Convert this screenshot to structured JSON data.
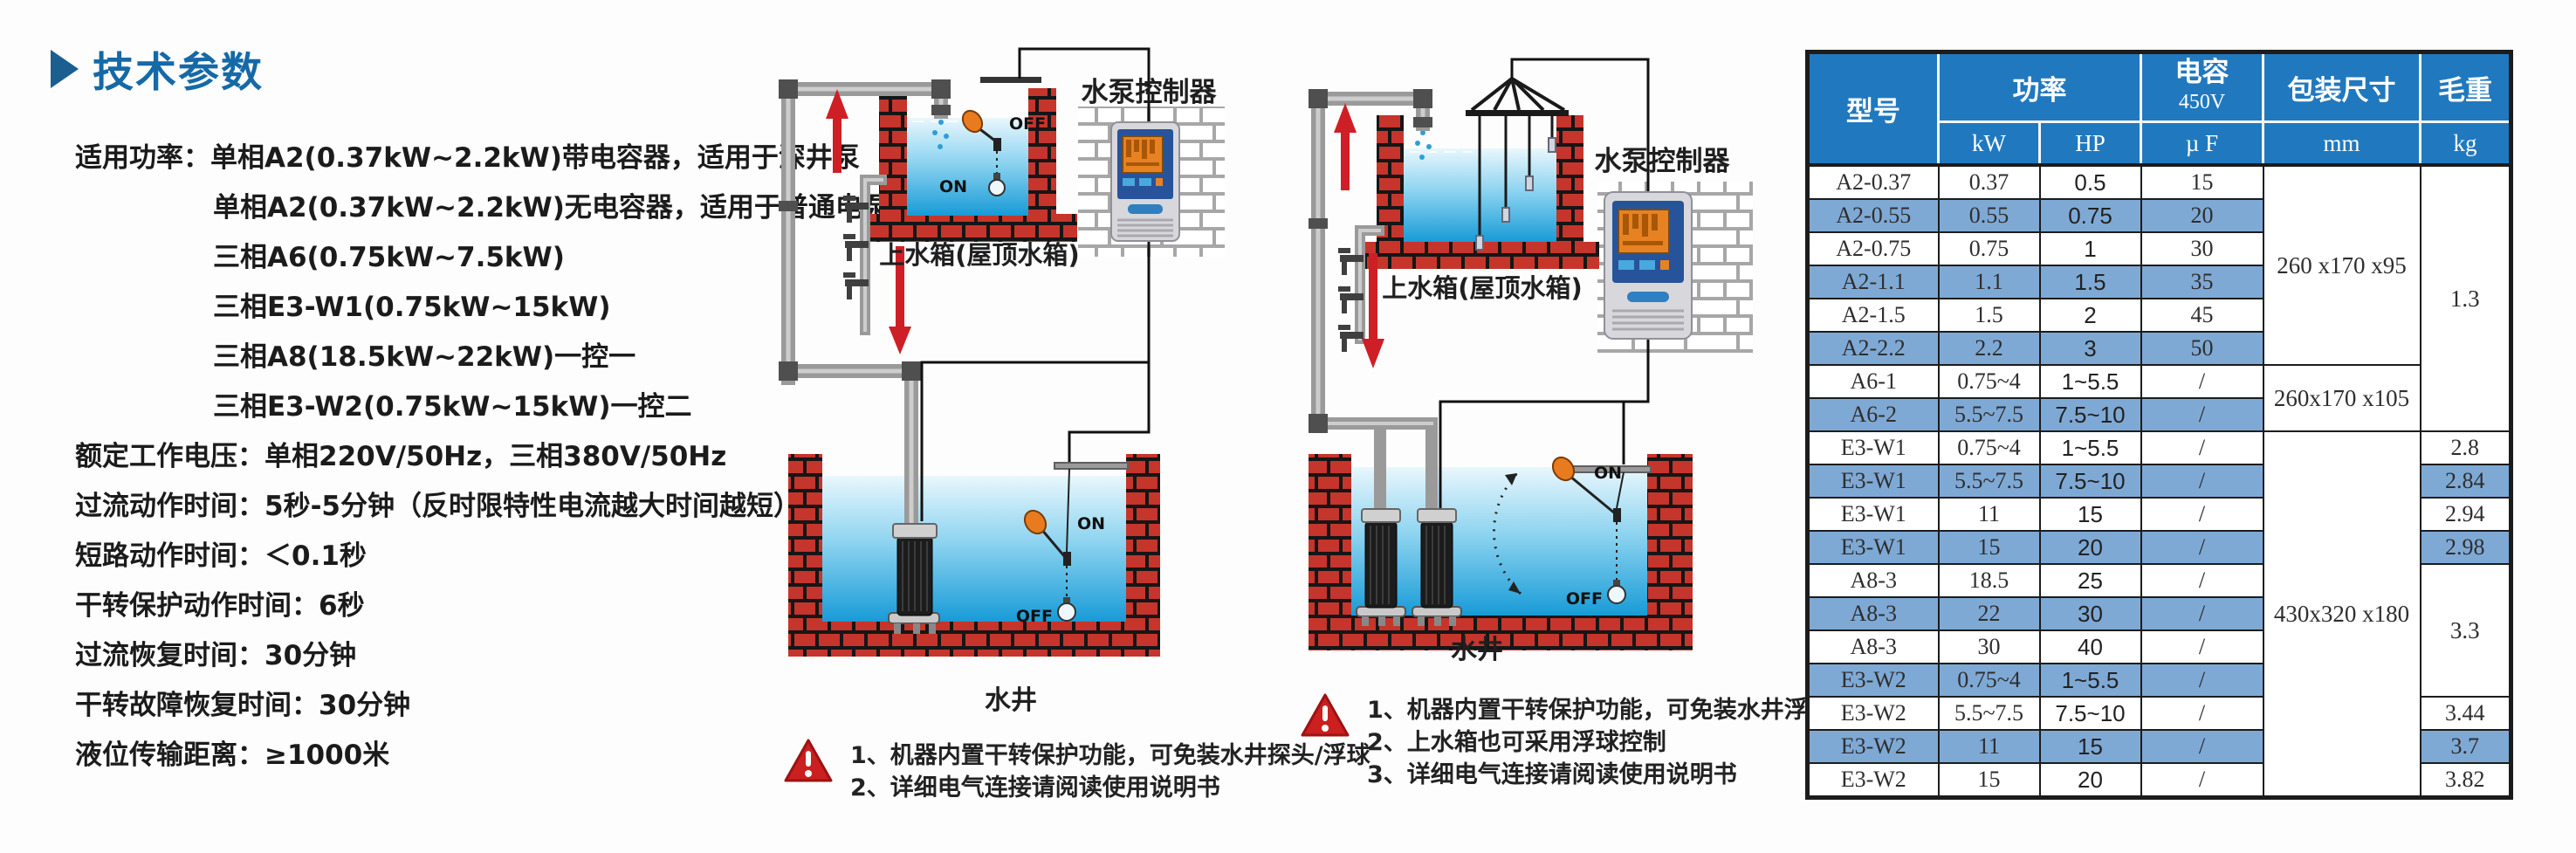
{
  "colors": {
    "header_blue": "#2079bf",
    "stripe_blue": "#7fa9d5",
    "title_blue": "#1569a7",
    "brick_red": "#c5352b",
    "warning_red": "#cc1f1f",
    "water_blue": "#189bd7",
    "float_orange": "#e87b1e"
  },
  "left_panel": {
    "title": "技术参数",
    "lines": [
      {
        "indent": false,
        "text": "适用功率：单相A2(0.37kW~2.2kW)带电容器，适用于深井泵"
      },
      {
        "indent": true,
        "text": "单相A2(0.37kW~2.2kW)无电容器，适用于普通电泵"
      },
      {
        "indent": true,
        "text": "三相A6(0.75kW~7.5kW)"
      },
      {
        "indent": true,
        "text": "三相E3-W1(0.75kW~15kW)"
      },
      {
        "indent": true,
        "text": "三相A8(18.5kW~22kW)一控一"
      },
      {
        "indent": true,
        "text": "三相E3-W2(0.75kW~15kW)一控二"
      },
      {
        "indent": false,
        "text": "额定工作电压：单相220V/50Hz，三相380V/50Hz"
      },
      {
        "indent": false,
        "text": "过流动作时间：5秒-5分钟（反时限特性电流越大时间越短）"
      },
      {
        "indent": false,
        "text": "短路动作时间：＜0.1秒"
      },
      {
        "indent": false,
        "text": "干转保护动作时间：6秒"
      },
      {
        "indent": false,
        "text": "过流恢复时间：30分钟"
      },
      {
        "indent": false,
        "text": "干转故障恢复时间：30分钟"
      },
      {
        "indent": false,
        "text": "液位传输距离：≥1000米"
      }
    ]
  },
  "diagram1": {
    "controller_label": "水泵控制器",
    "tank_label": "上水箱(屋顶水箱)",
    "well_label": "水井",
    "tank_off": "OFF",
    "tank_on": "ON",
    "well_on": "ON",
    "well_off": "OFF",
    "notes": [
      "1、机器内置干转保护功能，可免装水井探头/浮球",
      "2、详细电气连接请阅读使用说明书"
    ]
  },
  "diagram2": {
    "controller_label": "水泵控制器",
    "tank_label": "上水箱(屋顶水箱)",
    "well_label": "水井",
    "well_on": "ON",
    "well_off": "OFF",
    "notes": [
      "1、机器内置干转保护功能，可免装水井浮球",
      "2、上水箱也可采用浮球控制",
      "3、详细电气连接请阅读使用说明书"
    ]
  },
  "table": {
    "header": {
      "model": "型号",
      "power": "功率",
      "kw": "kW",
      "hp": "HP",
      "cap_line1": "电容",
      "cap_line2": "450V",
      "uf": "µ F",
      "pkg": "包装尺寸",
      "mm": "mm",
      "weight": "毛重",
      "kg": "kg"
    },
    "rows": [
      {
        "model": "A2-0.37",
        "kw": "0.37",
        "hp": "0.5",
        "uf": "15",
        "pkg": {
          "text": "260 x170 x95",
          "span": 6
        },
        "wt": {
          "text": "1.3",
          "span": 8
        }
      },
      {
        "model": "A2-0.55",
        "kw": "0.55",
        "hp": "0.75",
        "uf": "20"
      },
      {
        "model": "A2-0.75",
        "kw": "0.75",
        "hp": "1",
        "uf": "30"
      },
      {
        "model": "A2-1.1",
        "kw": "1.1",
        "hp": "1.5",
        "uf": "35"
      },
      {
        "model": "A2-1.5",
        "kw": "1.5",
        "hp": "2",
        "uf": "45"
      },
      {
        "model": "A2-2.2",
        "kw": "2.2",
        "hp": "3",
        "uf": "50"
      },
      {
        "model": "A6-1",
        "kw": "0.75~4",
        "hp": "1~5.5",
        "uf": "/",
        "pkg": {
          "text": "260x170 x105",
          "span": 2
        }
      },
      {
        "model": "A6-2",
        "kw": "5.5~7.5",
        "hp": "7.5~10",
        "uf": "/"
      },
      {
        "model": "E3-W1",
        "kw": "0.75~4",
        "hp": "1~5.5",
        "uf": "/",
        "pkg": {
          "text": "430x320 x180",
          "span": 11
        },
        "wt": {
          "text": "2.8"
        }
      },
      {
        "model": "E3-W1",
        "kw": "5.5~7.5",
        "hp": "7.5~10",
        "uf": "/",
        "wt": {
          "text": "2.84"
        }
      },
      {
        "model": "E3-W1",
        "kw": "11",
        "hp": "15",
        "uf": "/",
        "wt": {
          "text": "2.94"
        }
      },
      {
        "model": "E3-W1",
        "kw": "15",
        "hp": "20",
        "uf": "/",
        "wt": {
          "text": "2.98"
        }
      },
      {
        "model": "A8-3",
        "kw": "18.5",
        "hp": "25",
        "uf": "/",
        "wt": {
          "text": "3.3",
          "span": 4
        }
      },
      {
        "model": "A8-3",
        "kw": "22",
        "hp": "30",
        "uf": "/"
      },
      {
        "model": "A8-3",
        "kw": "30",
        "hp": "40",
        "uf": "/"
      },
      {
        "model": "E3-W2",
        "kw": "0.75~4",
        "hp": "1~5.5",
        "uf": "/"
      },
      {
        "model": "E3-W2",
        "kw": "5.5~7.5",
        "hp": "7.5~10",
        "uf": "/",
        "wt": {
          "text": "3.44"
        }
      },
      {
        "model": "E3-W2",
        "kw": "11",
        "hp": "15",
        "uf": "/",
        "wt": {
          "text": "3.7"
        }
      },
      {
        "model": "E3-W2",
        "kw": "15",
        "hp": "20",
        "uf": "/",
        "wt": {
          "text": "3.82"
        }
      }
    ]
  }
}
